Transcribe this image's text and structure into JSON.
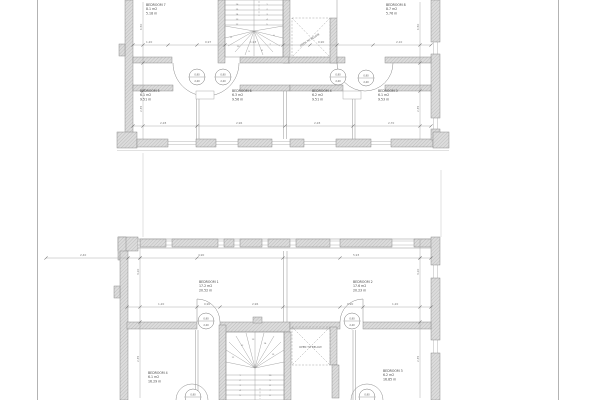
{
  "sheet": {
    "background": "#ffffff",
    "wall_fill": "#dcdcdc",
    "line_color": "#8a8a8a",
    "text_color": "#4a4a4a"
  },
  "upper_plan": {
    "void_label": "OPEN TO BELOW",
    "rooms": [
      {
        "x": 146,
        "y": 6,
        "lines": [
          "BEDROOM 7",
          "8.1 m2",
          "5.18 m"
        ]
      },
      {
        "x": 386,
        "y": 6,
        "lines": [
          "BEDROOM 8",
          "8.7 m2",
          "5.76 m"
        ]
      },
      {
        "x": 140,
        "y": 92,
        "lines": [
          "BEDROOM 5",
          "6.1 m2",
          "9.51 m"
        ]
      },
      {
        "x": 232,
        "y": 92,
        "lines": [
          "BEDROOM 6",
          "6.3 m2",
          "9.56 m"
        ]
      },
      {
        "x": 312,
        "y": 92,
        "lines": [
          "BEDROOM 4",
          "6.2 m2",
          "9.51 m"
        ]
      },
      {
        "x": 378,
        "y": 92,
        "lines": [
          "BEDROOM 3",
          "6.1 m2",
          "9.53 m"
        ]
      }
    ],
    "door_markers": [
      {
        "cx": 197,
        "cy": 77,
        "top": "0,90",
        "bottom": "2,20"
      },
      {
        "cx": 223,
        "cy": 77,
        "top": "0,90",
        "bottom": "2,20"
      },
      {
        "cx": 338,
        "cy": 77,
        "top": "0,90",
        "bottom": "2,20"
      },
      {
        "cx": 366,
        "cy": 78,
        "top": "0,90",
        "bottom": "2,20"
      }
    ],
    "dim_labels": [
      {
        "t": "1,20",
        "x": 146,
        "y": 43
      },
      {
        "t": "0,97",
        "x": 205,
        "y": 43
      },
      {
        "t": "1,93",
        "x": 250,
        "y": 43
      },
      {
        "t": "0,90",
        "x": 318,
        "y": 43
      },
      {
        "t": "2,10",
        "x": 396,
        "y": 43
      },
      {
        "t": "2,28",
        "x": 160,
        "y": 124
      },
      {
        "t": "2,96",
        "x": 236,
        "y": 124
      },
      {
        "t": "2,28",
        "x": 314,
        "y": 124
      },
      {
        "t": "2,70",
        "x": 388,
        "y": 124
      },
      {
        "t": "1,50",
        "x": 142,
        "y": 30,
        "rot": -90
      },
      {
        "t": "2,35",
        "x": 142,
        "y": 112,
        "rot": -90
      },
      {
        "t": "1,50",
        "x": 419,
        "y": 30,
        "rot": -90
      },
      {
        "t": "2,35",
        "x": 419,
        "y": 112,
        "rot": -90
      }
    ],
    "stair_numbers": [
      {
        "t": "16",
        "x": 237,
        "y": 5
      },
      {
        "t": "15",
        "x": 237,
        "y": 10
      },
      {
        "t": "14",
        "x": 237,
        "y": 15
      },
      {
        "t": "13",
        "x": 237,
        "y": 20
      },
      {
        "t": "12",
        "x": 237,
        "y": 25
      },
      {
        "t": "1",
        "x": 267,
        "y": 5
      },
      {
        "t": "2",
        "x": 267,
        "y": 10
      },
      {
        "t": "3",
        "x": 267,
        "y": 15
      },
      {
        "t": "4",
        "x": 267,
        "y": 20
      },
      {
        "t": "5",
        "x": 267,
        "y": 25
      },
      {
        "t": "6",
        "x": 274,
        "y": 36
      },
      {
        "t": "7",
        "x": 270,
        "y": 45
      },
      {
        "t": "8",
        "x": 262,
        "y": 51
      },
      {
        "t": "9",
        "x": 249,
        "y": 52
      },
      {
        "t": "10",
        "x": 238,
        "y": 47
      },
      {
        "t": "11",
        "x": 231,
        "y": 38
      }
    ]
  },
  "lower_plan": {
    "void_label": "OPEN TO BELOW",
    "rooms": [
      {
        "x": 199,
        "y": 283,
        "lines": [
          "BEDROOM 1",
          "17.2 m2",
          "20.52 m"
        ]
      },
      {
        "x": 353,
        "y": 283,
        "lines": [
          "BEDROOM 2",
          "17.6 m2",
          "20.23 m"
        ]
      },
      {
        "x": 148,
        "y": 374,
        "lines": [
          "BEDROOM 4",
          "6.1 m2",
          "16.29 m"
        ]
      },
      {
        "x": 383,
        "y": 372,
        "lines": [
          "BEDROOM 3",
          "6.2 m2",
          "16.85 m"
        ]
      }
    ],
    "door_markers": [
      {
        "cx": 206,
        "cy": 321,
        "top": "0,90",
        "bottom": "2,20"
      },
      {
        "cx": 352,
        "cy": 321,
        "top": "0,90",
        "bottom": "2,20"
      },
      {
        "cx": 193,
        "cy": 397,
        "top": "0,90",
        "bottom": "2,20"
      },
      {
        "cx": 367,
        "cy": 397,
        "top": "0,90",
        "bottom": "2,20"
      }
    ],
    "dim_labels": [
      {
        "t": "2,40",
        "x": 80,
        "y": 256
      },
      {
        "t": "4,90",
        "x": 198,
        "y": 256
      },
      {
        "t": "5,93",
        "x": 353,
        "y": 256
      },
      {
        "t": "1,20",
        "x": 158,
        "y": 305
      },
      {
        "t": "0,90",
        "x": 204,
        "y": 305
      },
      {
        "t": "2,96",
        "x": 252,
        "y": 305
      },
      {
        "t": "0,90",
        "x": 347,
        "y": 305
      },
      {
        "t": "1,20",
        "x": 392,
        "y": 305
      },
      {
        "t": "3,20",
        "x": 139,
        "y": 275,
        "rot": -90
      },
      {
        "t": "2,35",
        "x": 139,
        "y": 362,
        "rot": -90
      },
      {
        "t": "3,20",
        "x": 419,
        "y": 275,
        "rot": -90
      },
      {
        "t": "2,35",
        "x": 419,
        "y": 362,
        "rot": -90
      }
    ],
    "stair_numbers": [
      {
        "t": "1",
        "x": 240,
        "y": 376
      },
      {
        "t": "2",
        "x": 240,
        "y": 381
      },
      {
        "t": "3",
        "x": 240,
        "y": 386
      },
      {
        "t": "4",
        "x": 240,
        "y": 391
      },
      {
        "t": "5",
        "x": 240,
        "y": 396
      },
      {
        "t": "10",
        "x": 270,
        "y": 376
      },
      {
        "t": "9",
        "x": 270,
        "y": 381
      },
      {
        "t": "8",
        "x": 270,
        "y": 386
      },
      {
        "t": "7",
        "x": 270,
        "y": 391
      },
      {
        "t": "6",
        "x": 270,
        "y": 396
      },
      {
        "t": "11",
        "x": 233,
        "y": 358
      },
      {
        "t": "12",
        "x": 242,
        "y": 346
      },
      {
        "t": "13",
        "x": 253,
        "y": 340
      },
      {
        "t": "14",
        "x": 265,
        "y": 344
      },
      {
        "t": "15",
        "x": 273,
        "y": 355
      }
    ]
  }
}
